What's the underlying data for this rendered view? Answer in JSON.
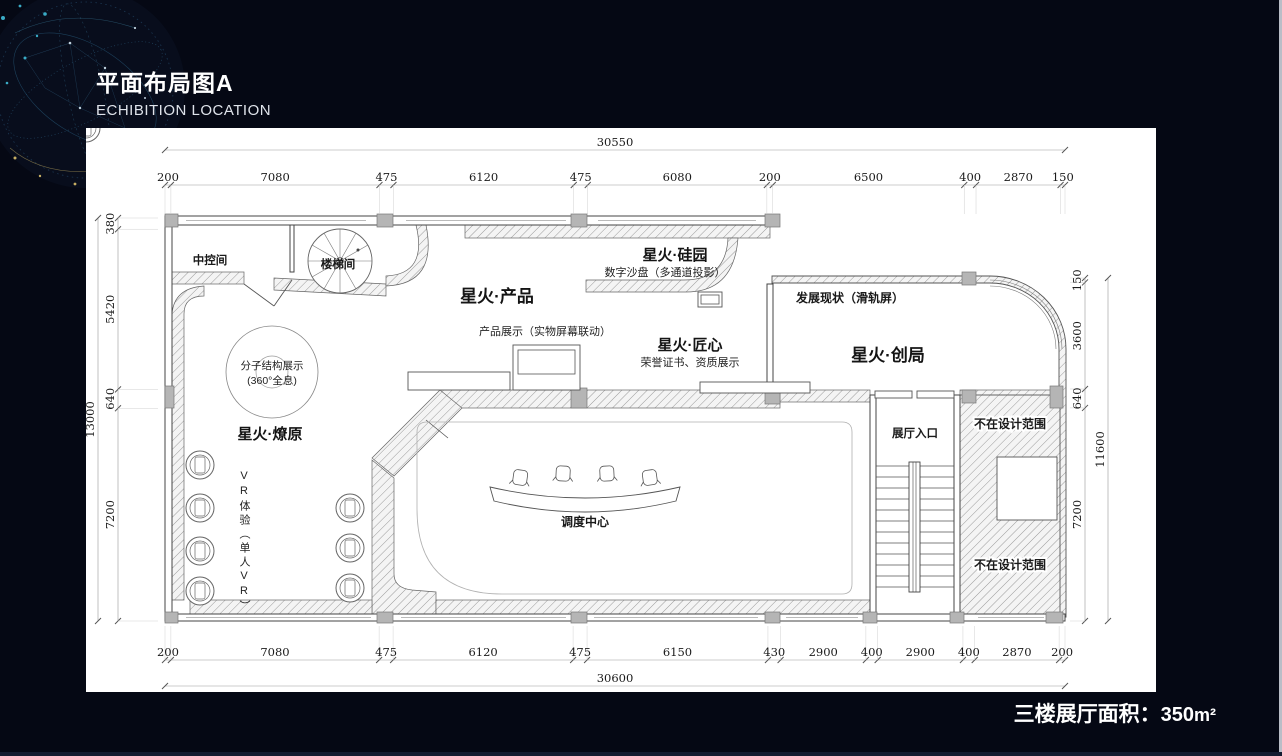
{
  "header": {
    "title": "平面布局图A",
    "subtitle": "ECHIBITION LOCATION"
  },
  "footer": {
    "area_label": "三楼展厅面积：",
    "area_value": "350",
    "area_unit": "m²"
  },
  "colors": {
    "background": "#050814",
    "panel": "#ffffff",
    "drawing_line": "#444444",
    "accent_dot": "#3fb9d6"
  },
  "plan": {
    "dims": {
      "top_total": "30550",
      "top": [
        "200",
        "7080",
        "475",
        "6120",
        "475",
        "6080",
        "200",
        "6500",
        "400",
        "2870",
        "150"
      ],
      "bottom": [
        "200",
        "7080",
        "475",
        "6120",
        "475",
        "6150",
        "430",
        "2900",
        "400",
        "2900",
        "400",
        "2870",
        "200"
      ],
      "bottom_total": "30600",
      "left": [
        "380",
        "5420",
        "640",
        "7200"
      ],
      "left_total": "13000",
      "right": [
        "150",
        "3600",
        "640",
        "7200"
      ],
      "right_total": "11600"
    },
    "rooms": {
      "zhongkong": "中控间",
      "louti": "楼梯间",
      "chanpin": "星火·产品",
      "guiyuan": "星火·硅园",
      "guiyuan_sub": "数字沙盘（多通道投影）",
      "fazhan": "发展现状（滑轨屏）",
      "chanpin_zhanshi": "产品展示（实物屏幕联动）",
      "jiangxin": "星火·匠心",
      "jiangxin_sub": "荣誉证书、资质展示",
      "chuangju": "星火·创局",
      "fenzi_1": "分子结构展示",
      "fenzi_2": "(360°全息)",
      "liaoyuan": "星火·燎原",
      "vr": "VR体验（单人VR）",
      "diaodu": "调度中心",
      "rukou": "展厅入口",
      "out_of_scope_1": "不在设计范围",
      "out_of_scope_2": "不在设计范围"
    }
  }
}
